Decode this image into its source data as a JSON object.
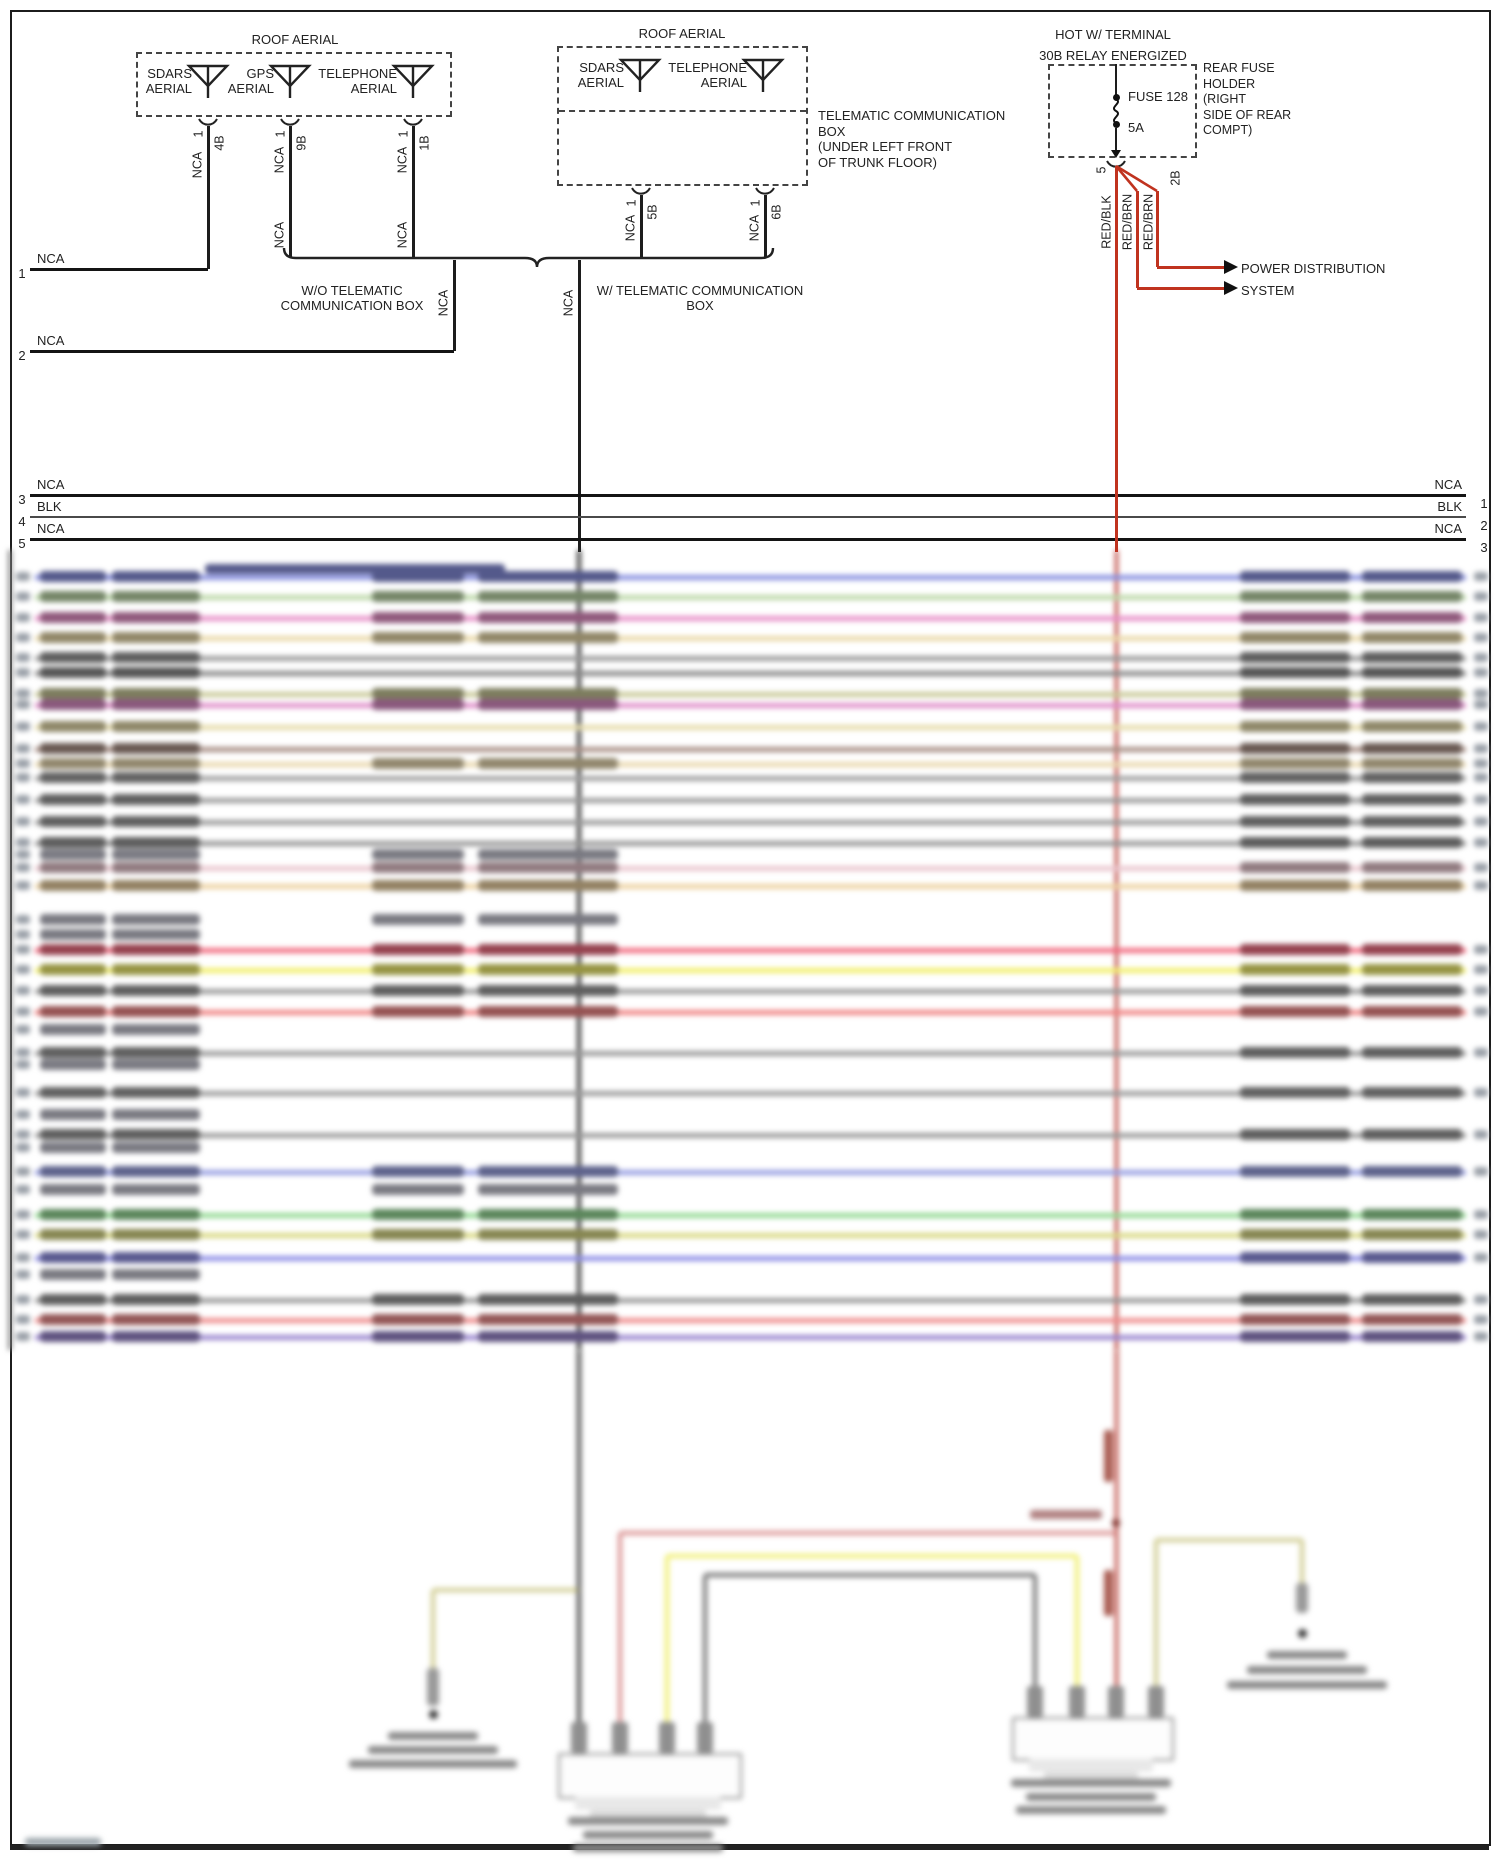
{
  "page_border_color": "#1c1c1c",
  "wire_black": "#1d1d1d",
  "wire_red": "#c0331f",
  "aerial_boxes": [
    {
      "title": "ROOF AERIAL",
      "x": 136,
      "y": 52,
      "w": 316,
      "h": 65,
      "title_cx": 295,
      "antennas": [
        {
          "label_lines": [
            "SDARS",
            "AERIAL"
          ],
          "sx": 208
        },
        {
          "label_lines": [
            "GPS",
            "AERIAL"
          ],
          "sx": 290
        },
        {
          "label_lines": [
            "TELEPHONE",
            "AERIAL"
          ],
          "sx": 413
        }
      ]
    },
    {
      "title": "ROOF AERIAL",
      "x": 557,
      "y": 46,
      "w": 251,
      "h": 64,
      "title_cx": 682,
      "ext_h": 76,
      "antennas": [
        {
          "label_lines": [
            "SDARS",
            "AERIAL"
          ],
          "sx": 640
        },
        {
          "label_lines": [
            "TELEPHONE",
            "AERIAL"
          ],
          "sx": 763
        }
      ]
    }
  ],
  "telematic_note": {
    "lines": [
      "TELEMATIC COMMUNICATION",
      "BOX",
      "(UNDER LEFT FRONT",
      "OF TRUNK FLOOR)"
    ],
    "x": 818,
    "y": 108
  },
  "aerial_wires": [
    {
      "x": 208,
      "y1": 117,
      "y2": 269,
      "pin": "1",
      "conn": "4B",
      "nca": [
        {
          "t": "NCA",
          "y": 165
        }
      ]
    },
    {
      "x": 290,
      "y1": 117,
      "y2": 258,
      "pin": "1",
      "conn": "9B",
      "nca": [
        {
          "t": "NCA",
          "y": 160
        },
        {
          "t": "NCA",
          "y": 235
        }
      ]
    },
    {
      "x": 413,
      "y1": 117,
      "y2": 258,
      "pin": "1",
      "conn": "1B",
      "nca": [
        {
          "t": "NCA",
          "y": 160
        },
        {
          "t": "NCA",
          "y": 235
        }
      ]
    },
    {
      "x": 641,
      "y1": 186,
      "y2": 258,
      "pin": "1",
      "conn": "5B",
      "nca": [
        {
          "t": "NCA",
          "y": 228
        }
      ]
    },
    {
      "x": 765,
      "y1": 186,
      "y2": 258,
      "pin": "1",
      "conn": "6B",
      "nca": [
        {
          "t": "NCA",
          "y": 228
        }
      ]
    },
    {
      "x": 454,
      "y1": 260,
      "y2": 351,
      "pin": "",
      "conn": "",
      "nca": [
        {
          "t": "NCA",
          "y": 303
        }
      ]
    },
    {
      "x": 579,
      "y1": 260,
      "y2": 552,
      "pin": "",
      "conn": "",
      "nca": [
        {
          "t": "NCA",
          "y": 303
        }
      ]
    }
  ],
  "brace": {
    "x1": 282,
    "x2": 775,
    "y": 258,
    "notch_x": 537,
    "left_lines": [
      "W/O TELEMATIC",
      "COMMUNICATION BOX"
    ],
    "left_cx": 352,
    "right_lines": [
      "W/ TELEMATIC COMMUNICATION",
      "BOX"
    ],
    "right_cx": 700,
    "text_y": 283
  },
  "hlines": [
    {
      "num": "1",
      "t": "NCA",
      "y": 269,
      "x1": 30,
      "x2": 208,
      "right": null
    },
    {
      "num": "2",
      "t": "NCA",
      "y": 351,
      "x1": 30,
      "x2": 454,
      "right": null
    },
    {
      "num": "3",
      "t": "NCA",
      "y": 495,
      "x1": 30,
      "x2": 1466,
      "right": {
        "t": "NCA",
        "num": "1"
      }
    },
    {
      "num": "4",
      "t": "BLK",
      "y": 517,
      "x1": 30,
      "x2": 1466,
      "thin": true,
      "right": {
        "t": "BLK",
        "num": "2"
      }
    },
    {
      "num": "5",
      "t": "NCA",
      "y": 539,
      "x1": 30,
      "x2": 1466,
      "right": {
        "t": "NCA",
        "num": "3"
      }
    }
  ],
  "fuse": {
    "title_lines": [
      "HOT W/ TERMINAL",
      "30B RELAY ENERGIZED"
    ],
    "title_cx": 1113,
    "title_y": 24,
    "box": {
      "x": 1048,
      "y": 64,
      "w": 149,
      "h": 94
    },
    "fx": 1116,
    "fuse_label": "FUSE 128",
    "amp_label": "5A",
    "holder_lines": [
      "REAR FUSE",
      "HOLDER",
      "(RIGHT",
      "SIDE OF REAR",
      "COMPT)"
    ],
    "holder_x": 1203,
    "holder_y": 61,
    "pin": "5",
    "conn": "2B",
    "wire_labels": [
      {
        "t": "RED/BLK",
        "x": 1107,
        "y": 222
      },
      {
        "t": "RED/BRN",
        "x": 1128,
        "y": 222
      },
      {
        "t": "RED/BRN",
        "x": 1149,
        "y": 222
      }
    ],
    "arrow_lines": [
      "POWER DISTRIBUTION",
      "SYSTEM"
    ],
    "arrow_tx": 1241,
    "arrow_ty": 258,
    "arrow_ys": [
      267,
      288
    ]
  },
  "wire_rows": [
    {
      "y": 577,
      "c": "#8890e0",
      "wide": true,
      "m": true,
      "r": true
    },
    {
      "y": 597,
      "c": "#bcd8a8",
      "m": true,
      "r": true
    },
    {
      "y": 618,
      "c": "#e890c8",
      "m": true,
      "r": true
    },
    {
      "y": 638,
      "c": "#ead9a8",
      "m": true,
      "r": true
    },
    {
      "y": 658,
      "c": "#9a9a9a",
      "r": true
    },
    {
      "y": 673,
      "c": "#8a8a8a",
      "r": true
    },
    {
      "y": 694,
      "c": "#c9c998",
      "m": true,
      "r": true
    },
    {
      "y": 705,
      "c": "#df8ec9",
      "m": true,
      "r": true
    },
    {
      "y": 727,
      "c": "#e6dcaa",
      "r": true
    },
    {
      "y": 749,
      "c": "#a98f85",
      "r": true
    },
    {
      "y": 764,
      "c": "#ead9b0",
      "m": true,
      "r": true
    },
    {
      "y": 778,
      "c": "#a0a0a0",
      "r": true
    },
    {
      "y": 800,
      "c": "#9a9a9a",
      "r": true
    },
    {
      "y": 822,
      "c": "#9a9a9a",
      "r": true
    },
    {
      "y": 843,
      "c": "#969696",
      "r": true
    },
    {
      "y": 868,
      "c": "#eac6ce",
      "m": true,
      "r": true
    },
    {
      "y": 886,
      "c": "#edd2a2",
      "m": true,
      "r": true
    },
    {
      "y": 950,
      "c": "#f26b80",
      "m": true,
      "r": true
    },
    {
      "y": 970,
      "c": "#f2ef6a",
      "m": true,
      "r": true
    },
    {
      "y": 991,
      "c": "#9a9a9a",
      "m": true,
      "r": true
    },
    {
      "y": 1012,
      "c": "#f08484",
      "m": true,
      "r": true
    },
    {
      "y": 1053,
      "c": "#9a9a9a",
      "r": true
    },
    {
      "y": 1093,
      "c": "#9c9c9c",
      "r": true
    },
    {
      "y": 1135,
      "c": "#9a9a9a",
      "r": true
    },
    {
      "y": 1172,
      "c": "#98a0e2",
      "m": true,
      "r": true
    },
    {
      "y": 1215,
      "c": "#94da94",
      "m": true,
      "r": true
    },
    {
      "y": 1235,
      "c": "#d9d985",
      "m": true,
      "r": true
    },
    {
      "y": 1258,
      "c": "#8f8fe6",
      "r": true
    },
    {
      "y": 1300,
      "c": "#989898",
      "m": true,
      "r": true
    },
    {
      "y": 1320,
      "c": "#ef8d8d",
      "m": true,
      "r": true
    },
    {
      "y": 1337,
      "c": "#9a86cf",
      "m": true,
      "r": true
    }
  ],
  "stub_labels": [
    {
      "y": 855,
      "m": true
    },
    {
      "y": 920,
      "m": true
    },
    {
      "y": 935
    },
    {
      "y": 1030
    },
    {
      "y": 1065
    },
    {
      "y": 1115
    },
    {
      "y": 1148
    },
    {
      "y": 1190,
      "m": true
    },
    {
      "y": 1275
    }
  ],
  "bottom": {
    "black_x": 579,
    "red_x": 1116,
    "junction_y": 1523,
    "red_branch": {
      "y": 1533,
      "x1": 620,
      "x2": 1116,
      "c": "#d98f8f"
    },
    "yellow": {
      "y": 1556,
      "x1": 667,
      "x2": 1077,
      "c": "#f0ee6e"
    },
    "gray": {
      "y": 1575,
      "x1": 705,
      "x2": 1035,
      "c": "#6f6f6f"
    },
    "olive_left": {
      "y": 1590,
      "x1": 433,
      "x2": 578,
      "c": "#cfcb8e"
    },
    "olive_right": {
      "y": 1540,
      "x1": 1156,
      "x2": 1302,
      "c": "#cfcb8e"
    },
    "comp_left": {
      "x": 558,
      "y": 1753,
      "w": 180,
      "h": 42,
      "stub_xs": [
        579,
        620,
        667,
        705
      ],
      "text_cx": 648
    },
    "comp_right": {
      "x": 1012,
      "y": 1717,
      "w": 158,
      "h": 40,
      "stub_xs": [
        1035,
        1077,
        1116,
        1156
      ],
      "text_cx": 1091
    },
    "ground_left": {
      "x": 433,
      "dot_y": 1714,
      "text_y": 1732
    },
    "ground_right": {
      "x": 1302,
      "dot_y": 1633,
      "text_y": 1651
    }
  }
}
